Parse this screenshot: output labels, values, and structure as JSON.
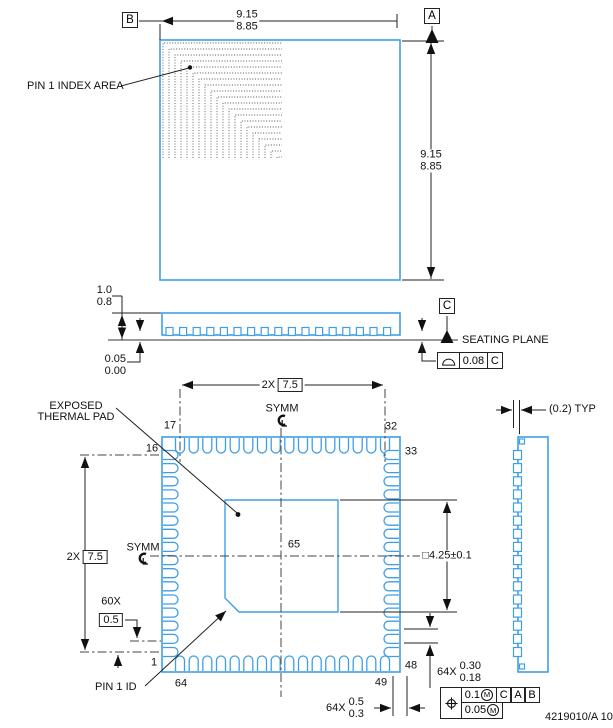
{
  "meta": {
    "doc_number": "4219010/A  10"
  },
  "colors": {
    "body": "#3f9ee8",
    "line": "#222222"
  },
  "package": {
    "pins_per_side": 16,
    "total_pins": 64
  },
  "top_view": {
    "pin1_index_label": "PIN 1 INDEX AREA",
    "datum_a": "A",
    "datum_b": "B",
    "dim_width_max": "9.15",
    "dim_width_min": "8.85",
    "dim_height_max": "9.15",
    "dim_height_min": "8.85"
  },
  "side_view": {
    "dim_height_max": "1.0",
    "dim_height_min": "0.8",
    "dim_standoff_max": "0.05",
    "dim_standoff_min": "0.00",
    "datum_c": "C",
    "seating_plane": "SEATING PLANE",
    "flatness_value": "0.08",
    "flatness_datum": "C"
  },
  "bottom_view": {
    "exposed_pad_line1": "EXPOSED",
    "exposed_pad_line2": "THERMAL PAD",
    "span_top_qty": "2X",
    "span_top_value": "7.5",
    "span_left_qty": "2X",
    "span_left_value": "7.5",
    "symm_top": "SYMM",
    "symm_left": "SYMM",
    "pad_dim": "□4.25±0.1",
    "pitch_qty": "60X",
    "pitch_value": "0.5",
    "pin1_id_label": "PIN 1 ID",
    "pad_center_pin": "65",
    "pin_1": "1",
    "pin_16": "16",
    "pin_17": "17",
    "pin_32": "32",
    "pin_33": "33",
    "pin_48": "48",
    "pin_49": "49",
    "pin_64": "64",
    "lead_width_qty": "64X",
    "lead_width_max": "0.30",
    "lead_width_min": "0.18",
    "lead_len_qty": "64X",
    "lead_len_max": "0.5",
    "lead_len_min": "0.3",
    "fcf": {
      "tol1": "0.1",
      "mod1": "M",
      "datum1": "C",
      "datum2": "A",
      "datum3": "B",
      "tol2": "0.05",
      "mod2": "M"
    }
  },
  "detail": {
    "lead_offset": "(0.2) TYP"
  }
}
